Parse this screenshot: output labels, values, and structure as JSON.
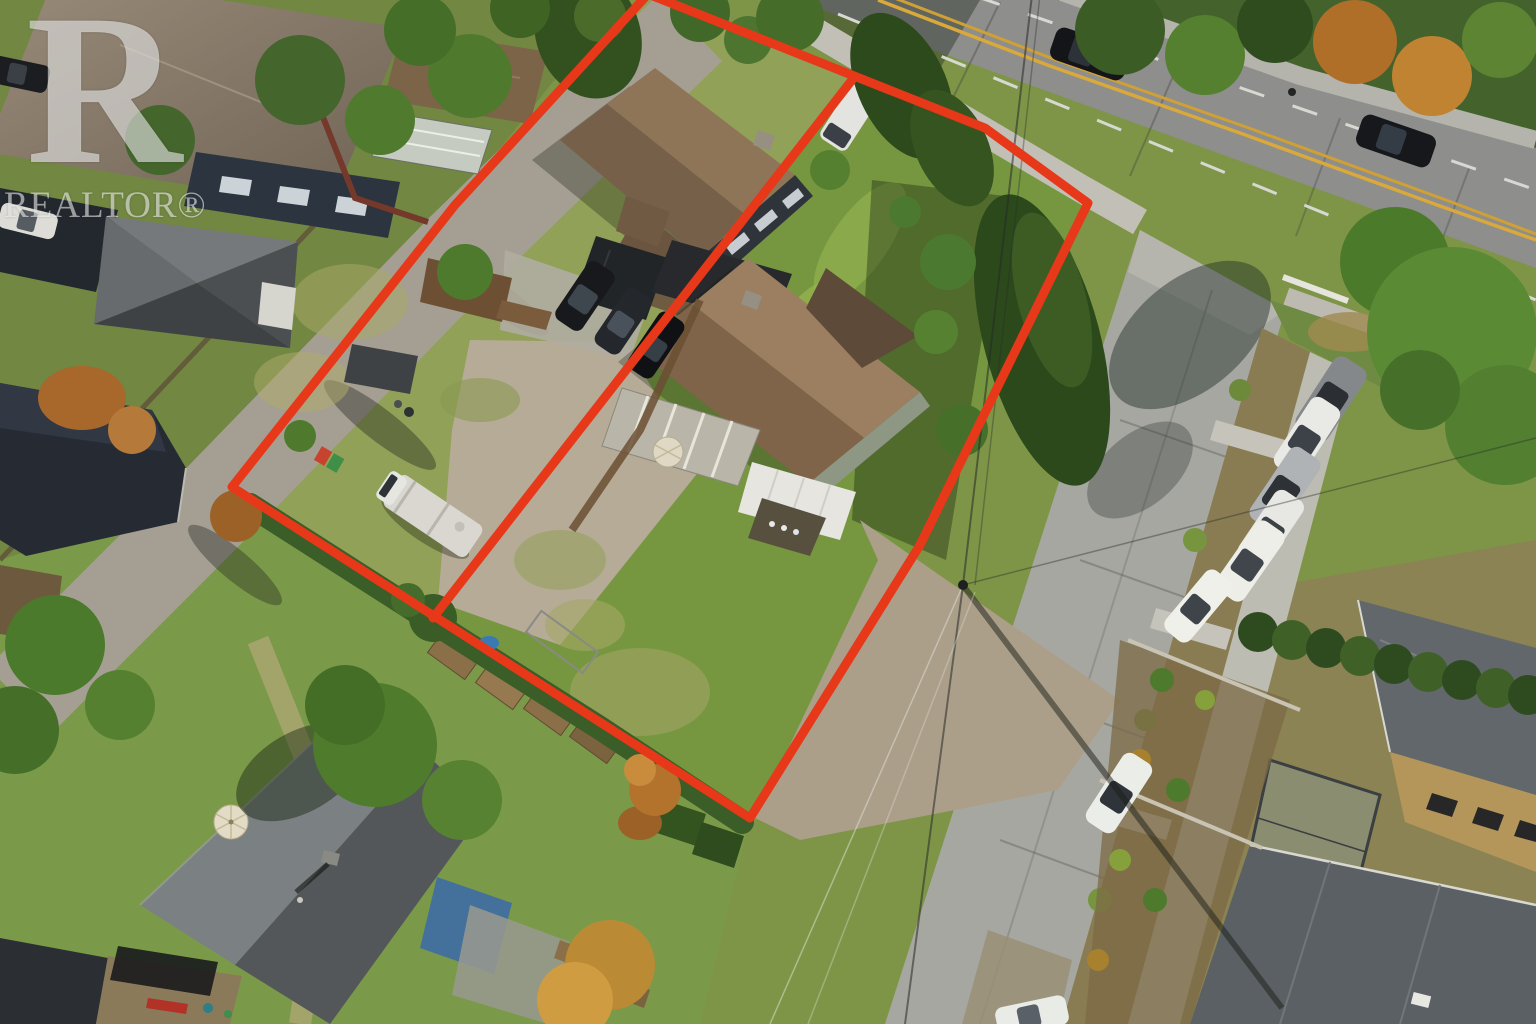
{
  "image": {
    "kind": "aerial-drone-real-estate-photo",
    "description": "Overhead drone photo of two adjacent residential lots outlined in red, bordered by a main road at top, a side street at right, a rear lane at left, with houses, parked cars, an RV, lawns, gravel yards, gardens and mature trees.",
    "width": 1536,
    "height": 1024
  },
  "watermark": {
    "logo_letter": "R",
    "label": "REALTOR®",
    "color": "#ffffff",
    "opacity": 0.55
  },
  "property_outline": {
    "color": "#e73819",
    "stroke_width": 9,
    "outer_points": "648,-6 985,128 1088,203 920,545 750,818 232,487 455,205",
    "divider_points": "852,80 433,618"
  },
  "palette": {
    "outline_red": "#e73819",
    "asphalt": "#8e8e8c",
    "concrete_street": "#a7a7a1",
    "sidewalk": "#c2c0b6",
    "gravel": "#b5ab97",
    "lawn_green": "#74973f",
    "lawn_dry": "#9aa65e",
    "roof_brown": "#8f7558",
    "roof_gray": "#53575a",
    "conifer_green": "#2d4a1c",
    "autumn_orange": "#b06f28",
    "yellow_line": "#d9a93b"
  },
  "scene": {
    "roads": [
      "main-road-top",
      "side-street-right",
      "rear-lane-left"
    ],
    "lots": [
      "left-lot-with-house-and-driveway",
      "right-lot-with-house-and-lawn"
    ],
    "vehicle_counts": {
      "road_moving_cars": 2,
      "side_street_parked": 7,
      "driveway_dark_cars": 3,
      "white_van_in_lot": 1,
      "rv_travel_trailer": 1,
      "lane_and_edge_cars": 2
    },
    "features": [
      "two-houses-inside-outline",
      "carport",
      "sheds",
      "sunroom-roof",
      "patio-umbrellas",
      "vegetable-garden",
      "cedar-hedges",
      "power-pole-and-wires",
      "modern-house-bottom-right"
    ]
  }
}
